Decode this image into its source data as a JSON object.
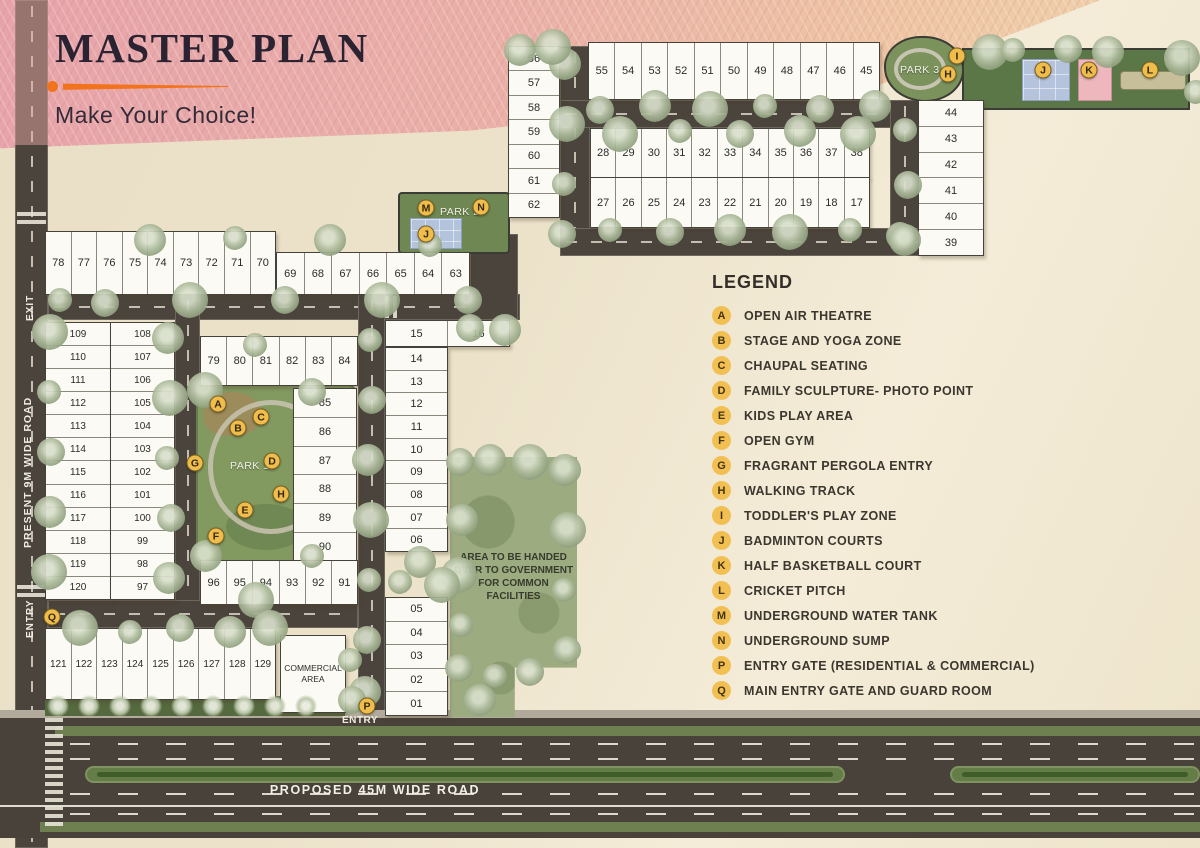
{
  "header": {
    "title": "MASTER PLAN",
    "subtitle": "Make Your Choice!"
  },
  "legend": {
    "title": "LEGEND",
    "items": [
      {
        "key": "A",
        "label": "OPEN AIR THEATRE"
      },
      {
        "key": "B",
        "label": "STAGE AND YOGA ZONE"
      },
      {
        "key": "C",
        "label": "CHAUPAL SEATING"
      },
      {
        "key": "D",
        "label": "FAMILY SCULPTURE- PHOTO POINT"
      },
      {
        "key": "E",
        "label": "KIDS PLAY AREA"
      },
      {
        "key": "F",
        "label": "OPEN GYM"
      },
      {
        "key": "G",
        "label": "FRAGRANT PERGOLA ENTRY"
      },
      {
        "key": "H",
        "label": "WALKING TRACK"
      },
      {
        "key": "I",
        "label": "TODDLER'S PLAY ZONE"
      },
      {
        "key": "J",
        "label": "BADMINTON COURTS"
      },
      {
        "key": "K",
        "label": "HALF BASKETBALL COURT"
      },
      {
        "key": "L",
        "label": "CRICKET PITCH"
      },
      {
        "key": "M",
        "label": "UNDERGROUND WATER TANK"
      },
      {
        "key": "N",
        "label": "UNDERGROUND SUMP"
      },
      {
        "key": "P",
        "label": "ENTRY GATE (RESIDENTIAL & COMMERCIAL)"
      },
      {
        "key": "Q",
        "label": "MAIN ENTRY GATE AND GUARD ROOM"
      }
    ]
  },
  "roads": {
    "left_label": "PRESENT 9M WIDE ROAD",
    "bottom_label": "PROPOSED 45M WIDE ROAD",
    "exit_label": "EXIT",
    "entry_left_label": "ENTRY",
    "entry_bottom_label": "ENTRY"
  },
  "areas": {
    "park1": "PARK 1",
    "park2": "PARK 2",
    "park3": "PARK 3",
    "commercial": "COMMERCIAL AREA",
    "government": "AREA TO BE HANDED OVER TO GOVERNMENT FOR COMMON FACILITIES"
  },
  "plot_groups": {
    "col_56_62": [
      "56",
      "57",
      "58",
      "59",
      "60",
      "61",
      "62"
    ],
    "row_55_45": [
      "55",
      "54",
      "53",
      "52",
      "51",
      "50",
      "49",
      "48",
      "47",
      "46",
      "45"
    ],
    "col_44_39": [
      "44",
      "43",
      "42",
      "41",
      "40",
      "39"
    ],
    "row_28_38": [
      "28",
      "29",
      "30",
      "31",
      "32",
      "33",
      "34",
      "35",
      "36",
      "37",
      "38"
    ],
    "row_27_17": [
      "27",
      "26",
      "25",
      "24",
      "23",
      "22",
      "21",
      "20",
      "19",
      "18",
      "17"
    ],
    "row_78_70": [
      "78",
      "77",
      "76",
      "75",
      "74",
      "73",
      "72",
      "71",
      "70"
    ],
    "row_69_63": [
      "69",
      "68",
      "67",
      "66",
      "65",
      "64",
      "63"
    ],
    "col_109_120": [
      "109",
      "110",
      "111",
      "112",
      "113",
      "114",
      "115",
      "116",
      "117",
      "118",
      "119",
      "120"
    ],
    "col_108_97": [
      "108",
      "107",
      "106",
      "105",
      "104",
      "103",
      "102",
      "101",
      "100",
      "99",
      "98",
      "97"
    ],
    "row_79_84": [
      "79",
      "80",
      "81",
      "82",
      "83",
      "84"
    ],
    "col_85_90": [
      "85",
      "86",
      "87",
      "88",
      "89",
      "90"
    ],
    "row_96_91": [
      "96",
      "95",
      "94",
      "93",
      "92",
      "91"
    ],
    "row_15_16": [
      "15",
      "16"
    ],
    "col_14_06": [
      "14",
      "13",
      "12",
      "11",
      "10",
      "09",
      "08",
      "07",
      "06"
    ],
    "col_05_01": [
      "05",
      "04",
      "03",
      "02",
      "01"
    ],
    "row_121_129": [
      "121",
      "122",
      "123",
      "124",
      "125",
      "126",
      "127",
      "128",
      "129"
    ]
  },
  "map_markers": [
    {
      "key": "A",
      "x": 218,
      "y": 404
    },
    {
      "key": "B",
      "x": 238,
      "y": 428
    },
    {
      "key": "C",
      "x": 261,
      "y": 417
    },
    {
      "key": "D",
      "x": 272,
      "y": 461
    },
    {
      "key": "E",
      "x": 245,
      "y": 510
    },
    {
      "key": "F",
      "x": 216,
      "y": 536
    },
    {
      "key": "G",
      "x": 195,
      "y": 463
    },
    {
      "key": "H",
      "x": 281,
      "y": 494
    },
    {
      "key": "H",
      "x": 948,
      "y": 74
    },
    {
      "key": "I",
      "x": 957,
      "y": 56
    },
    {
      "key": "J",
      "x": 426,
      "y": 234
    },
    {
      "key": "J",
      "x": 1043,
      "y": 70
    },
    {
      "key": "K",
      "x": 1089,
      "y": 70
    },
    {
      "key": "L",
      "x": 1150,
      "y": 70
    },
    {
      "key": "M",
      "x": 426,
      "y": 208
    },
    {
      "key": "N",
      "x": 481,
      "y": 207
    },
    {
      "key": "P",
      "x": 367,
      "y": 706
    },
    {
      "key": "Q",
      "x": 52,
      "y": 617
    }
  ],
  "colors": {
    "accent_orange": "#f2731d",
    "banner_pink": "#e7a3aa",
    "road": "#4a443d",
    "park_green": "#829960",
    "marker_yellow": "#f0bd4c",
    "paper": "#ece2ca"
  }
}
